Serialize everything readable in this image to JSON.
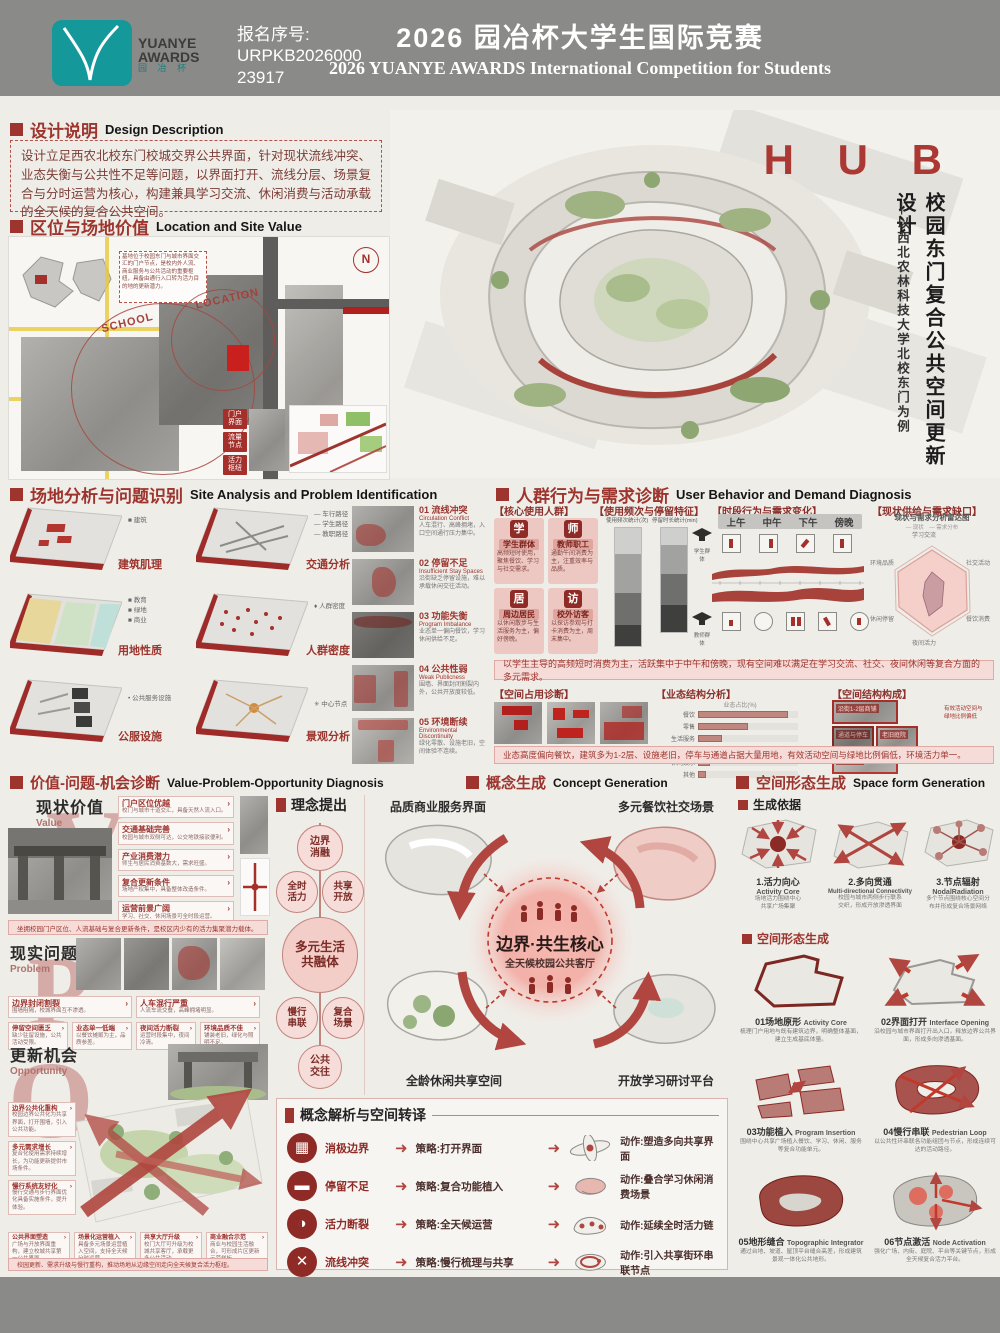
{
  "header": {
    "reg_label": "报名序号:",
    "reg_no1": "URPKB2026000",
    "reg_no2": "23917",
    "title_cn": "2026 园冶杯大学生国际竞赛",
    "title_en": "2026 YUANYE AWARDS International Competition for Students",
    "logo": {
      "line1": "YUANYE",
      "line2": "AWARDS",
      "line3": "园 冶 杯"
    }
  },
  "hero": {
    "title": "H U B",
    "sub_main": "校园东门复合公共空间更新设计",
    "sub_dash": "—以西北农林科技大学北校东门为例"
  },
  "design_desc": {
    "cn": "设计说明",
    "en": "Design Description",
    "body": "设计立足西农北校东门校城交界公共界面，针对现状流线冲突、业态失衡与公共性不足等问题，以界面打开、流线分层、场景复合与分时运营为核心，构建兼具学习交流、休闲消费与活动承载的全天候的复合公共空间。"
  },
  "location": {
    "cn": "区位与场地价值",
    "en": "Location and Site Value",
    "school": "SCHOOL",
    "loc": "LOCATION",
    "compass": "N",
    "note": "基地位于校园东门与城市界面交汇的门户节点，是校内外人流、商业服务与公共活动的重要枢纽，具备由通行入口转为活力目的地的更新潜力。",
    "tags": [
      "门户\n界面",
      "流量\n节点",
      "活力\n枢纽"
    ]
  },
  "site": {
    "cn": "场地分析与问题识别",
    "en": "Site Analysis and Problem Identification",
    "diagrams": [
      {
        "label": "建筑肌理",
        "legend": "■ 建筑"
      },
      {
        "label": "交通分析",
        "legend": "— 车行路径\n— 学生路径\n— 教职路径"
      },
      {
        "label": "用地性质",
        "legend": "■ 教育\n■ 绿地\n■ 商业"
      },
      {
        "label": "人群密度",
        "legend": "♦ 人群密度"
      },
      {
        "label": "公服设施",
        "legend": "• 公共服务设施"
      },
      {
        "label": "景观分析",
        "legend": "✳ 中心节点"
      }
    ],
    "problems": [
      {
        "no": "01",
        "cn": "流线冲突",
        "en": "Circulation Conflict",
        "desc": "人车混行、高峰拥堵，入口空间通行压力集中。"
      },
      {
        "no": "02",
        "cn": "停留不足",
        "en": "Insufficient Stay Spaces",
        "desc": "沿街缺乏停留设施，难以承载休闲交往活动。"
      },
      {
        "no": "03",
        "cn": "功能失衡",
        "en": "Program Imbalance",
        "desc": "业态单一偏向餐饮，学习休闲供给不足。"
      },
      {
        "no": "04",
        "cn": "公共性弱",
        "en": "Weak Publicness",
        "desc": "围墙、界面封闭割裂内外，公共开放度较低。"
      },
      {
        "no": "05",
        "cn": "环境断续",
        "en": "Environmental Discontinuity",
        "desc": "绿化零散、设施老旧，空间体验不连续。"
      }
    ]
  },
  "behavior": {
    "cn": "人群行为与需求诊断",
    "en": "User Behavior and Demand Diagnosis",
    "groups_label": "【核心使用人群】",
    "groups": [
      {
        "icon": "学",
        "name": "学生群体",
        "desc": "高频短时使用，聚焦餐饮、学习与社交需求。"
      },
      {
        "icon": "师",
        "name": "教师职工",
        "desc": "通勤午间消费为主，注重效率与品质。"
      },
      {
        "icon": "居",
        "name": "周边居民",
        "desc": "以休闲散步与生活服务为主，偏好傍晚。"
      },
      {
        "icon": "访",
        "name": "校外访客",
        "desc": "以探访参观与打卡消费为主，周末集中。"
      }
    ],
    "freq_label": "【使用频次与停留特征】",
    "bar1_title": "使用频次统计(次)",
    "bar2_title": "停留时长统计(min)",
    "side_top": "学生群体",
    "side_bottom": "教师群体",
    "time_label": "【时段行为与需求变化】",
    "periods": [
      "上午",
      "中午",
      "下午",
      "傍晚"
    ],
    "gap_label": "【现状供给与需求缺口】",
    "radar_title": "现状与需求分析雷达图",
    "radar_legend": "— 现状　— 需求分布",
    "radar_axes": [
      "学习交流",
      "社交活动",
      "餐饮消费",
      "夜间活力",
      "休闲停留",
      "环境品质"
    ],
    "summary1": "以学生主导的高频短时消费为主，活跃集中于中午和傍晚，现有空间难以满足在学习交流、社交、夜间休闲等复合方面的多元需求。",
    "occupancy_label": "【空间占用诊断】",
    "business_label": "【业态结构分析】",
    "business_title": "业态占比(%)",
    "business_cats": [
      "餐饮",
      "零售",
      "生活服务",
      "文化学习",
      "休闲娱乐",
      "其他"
    ],
    "structure_label": "【空间结构构成】",
    "structure_tags": [
      "沿街1-2层商铺",
      "通道与停车",
      "老旧庭院",
      "围墙界面"
    ],
    "structure_note": "有效活动空间与\n绿地比例偏低",
    "summary2": "业态高度偏向餐饮，建筑多为1-2层、设施老旧，停车与通道占据大量用地，有效活动空间与绿地比例偏低，环境活力单一。"
  },
  "vpo": {
    "cn": "价值-问题-机会诊断",
    "en": "Value-Problem-Opportunity Diagnosis",
    "value": {
      "cn": "现状价值",
      "en": "Value",
      "letter": "V",
      "items": [
        {
          "t": "门户区位优越",
          "d": "校门与城市干道交汇，具备天然人流入口。"
        },
        {
          "t": "交通基础完善",
          "d": "校园与城市双侧可达，公交地铁接驳便利。"
        },
        {
          "t": "产业消费潜力",
          "d": "师生与居民消费基数大，需求旺盛。"
        },
        {
          "t": "复合更新条件",
          "d": "场地产权集中，具备整体改造条件。"
        },
        {
          "t": "运营前景广阔",
          "d": "学习、社交、休闲场景可全时段运营。"
        }
      ],
      "summary": "坐拥校园门户区位、人流基础与复合更新条件，是校区内少有的活力集聚潜力载体。"
    },
    "problem": {
      "cn": "现实问题",
      "en": "Problem",
      "letter": "P",
      "items": [
        {
          "t": "边界封闭割裂",
          "d": "围墙阻隔，校城界面互不渗透。"
        },
        {
          "t": "人车混行严重",
          "d": "人流车流交叠，高峰拥堵明显。"
        },
        {
          "t": "停留空间匮乏",
          "d": "缺少驻留设施，公共活动受限。"
        },
        {
          "t": "业态单一低端",
          "d": "以餐饮摊贩为主，品质参差。"
        },
        {
          "t": "夜间活力断裂",
          "d": "运营时段集中，夜间冷清。"
        },
        {
          "t": "环境品质不佳",
          "d": "铺装老旧，绿化与照明不足。"
        }
      ]
    },
    "opp": {
      "cn": "更新机会",
      "en": "Opportunity",
      "letter": "O",
      "items_left": [
        {
          "t": "边界公共化重构",
          "d": "校园边界公共化为共享界面，打开围墙，引入公共功能。"
        },
        {
          "t": "多元需求增长",
          "d": "复合化使用需求持续增长，为功能更新提供市场条件。"
        },
        {
          "t": "慢行系统友好化",
          "d": "慢行交通与步行界面优化具备实施条件，提升体验。"
        }
      ],
      "items_bottom": [
        {
          "t": "公共界面塑造",
          "d": "广场与开放界面重构，建立校城共享第一公共界面。"
        },
        {
          "t": "场景化运营植入",
          "d": "具备多元场景运营植入空间，支持全天候分时运营。"
        },
        {
          "t": "共享大厅升级",
          "d": "校门大厅可升级为校城共享客厅，承载更多公共活动。"
        },
        {
          "t": "商业融合示范",
          "d": "商业与校园生活融合，可形成片区更新示范样板。"
        }
      ],
      "summary": "校园更新、需求升级与慢行重构，推动场地从边缘空间走向全天候复合活力枢纽。"
    }
  },
  "concept": {
    "cn": "概念生成",
    "en": "Concept Generation",
    "proposal_header": "理念提出",
    "bubble_top": "边界\n消融",
    "bubble_l1": "全时\n活力",
    "bubble_r1": "共享\n开放",
    "bubble_center": "多元生活\n共融体",
    "bubble_l2": "慢行\n串联",
    "bubble_r2": "复合\n场景",
    "bubble_bottom": "公共\n交往",
    "corner_tl": "品质商业服务界面",
    "corner_tr": "多元餐饮社交场景",
    "corner_bl": "全龄休闲共享空间",
    "corner_br": "开放学习研讨平台",
    "core_title": "边界·共生核心",
    "core_sub": "全天候校园公共客厅",
    "trans_header": "概念解析与空间转译",
    "rows": [
      {
        "icon": "▦",
        "problem": "消极边界",
        "strategy": "策略:打开界面",
        "action": "动作:塑造多向共享界面"
      },
      {
        "icon": "▬",
        "problem": "停留不足",
        "strategy": "策略:复合功能植入",
        "action": "动作:叠合学习休闲消费场景"
      },
      {
        "icon": "◑",
        "problem": "活力断裂",
        "strategy": "策略:全天候运营",
        "action": "动作:延续全时活力链"
      },
      {
        "icon": "✕",
        "problem": "流线冲突",
        "strategy": "策略:慢行梳理与共享",
        "action": "动作:引入共享街环串联节点"
      }
    ]
  },
  "form": {
    "cn": "空间形态生成",
    "en": "Space form Generation",
    "basis_header": "生成依据",
    "basis": [
      {
        "no": "1.",
        "cn": "活力向心",
        "en": "Activity Core",
        "desc": "场地活力围绕中心\n共享广场集聚"
      },
      {
        "no": "2.",
        "cn": "多向贯通",
        "en": "Multi-directional Connectivity",
        "desc": "校园与城市两侧步行联系\n交织，形成开放渗透界面"
      },
      {
        "no": "3.",
        "cn": "节点辐射",
        "en": "NodalRadiation",
        "desc": "多个节点围绕核心空间分\n布并形成复合场景网络"
      }
    ],
    "steps_header": "空间形态生成",
    "steps": [
      {
        "no": "01",
        "cn": "场地原形",
        "en": "Activity Core",
        "desc": "梳理门户用地与既有建筑边界，明确整体基面，建立生成基底体量。"
      },
      {
        "no": "02",
        "cn": "界面打开",
        "en": "Interface Opening",
        "desc": "沿校园与城市界面打开出入口，释放边界公共界面，形成多向渗透基面。"
      },
      {
        "no": "03",
        "cn": "功能植入",
        "en": "Program Insertion",
        "desc": "围绕中心共享广场植入餐饮、学习、休闲、服务等复合功能单元。"
      },
      {
        "no": "04",
        "cn": "慢行串联",
        "en": "Pedestrian Loop",
        "desc": "以公共性环串联各功能组团与节点，形成连续可达的活动路径。"
      },
      {
        "no": "05",
        "cn": "地形缝合",
        "en": "Topographic Integrator",
        "desc": "通过台地、坡道、屋顶平台缝合高差，形成建筑景观一体化公共地形。"
      },
      {
        "no": "06",
        "cn": "节点激活",
        "en": "Node Activation",
        "desc": "强化广场、内街、庭院、平台等关键节点，形成全天候复合活力平台。"
      }
    ]
  },
  "chart_data": [
    {
      "type": "bar",
      "stacked": true,
      "title": "使用频次统计(次)",
      "categories": [
        "学生",
        "教师",
        "居民",
        "访客"
      ],
      "values": [
        45,
        25,
        18,
        12
      ]
    },
    {
      "type": "bar",
      "stacked": true,
      "title": "停留时长统计(min)",
      "categories": [
        "学生",
        "教师",
        "居民",
        "访客"
      ],
      "values": [
        40,
        25,
        20,
        15
      ]
    },
    {
      "type": "area",
      "title": "时段行为与需求变化",
      "x": [
        "8",
        "10",
        "12",
        "14",
        "16",
        "18",
        "20"
      ],
      "series": [
        {
          "name": "活跃度",
          "values": [
            20,
            35,
            80,
            45,
            50,
            90,
            40
          ]
        }
      ],
      "xlabel": "时段",
      "ylabel": "活跃度"
    },
    {
      "type": "radar",
      "title": "现状与需求分析雷达图",
      "axes": [
        "学习交流",
        "社交活动",
        "餐饮消费",
        "夜间活力",
        "休闲停留",
        "环境品质"
      ],
      "series": [
        {
          "name": "需求",
          "values": [
            80,
            70,
            85,
            75,
            70,
            65
          ]
        },
        {
          "name": "现状",
          "values": [
            35,
            30,
            70,
            25,
            30,
            30
          ]
        }
      ]
    },
    {
      "type": "bar",
      "title": "业态占比(%)",
      "categories": [
        "餐饮",
        "零售",
        "生活服务",
        "文化学习",
        "休闲娱乐",
        "其他"
      ],
      "values": [
        45,
        25,
        12,
        8,
        6,
        4
      ]
    }
  ]
}
